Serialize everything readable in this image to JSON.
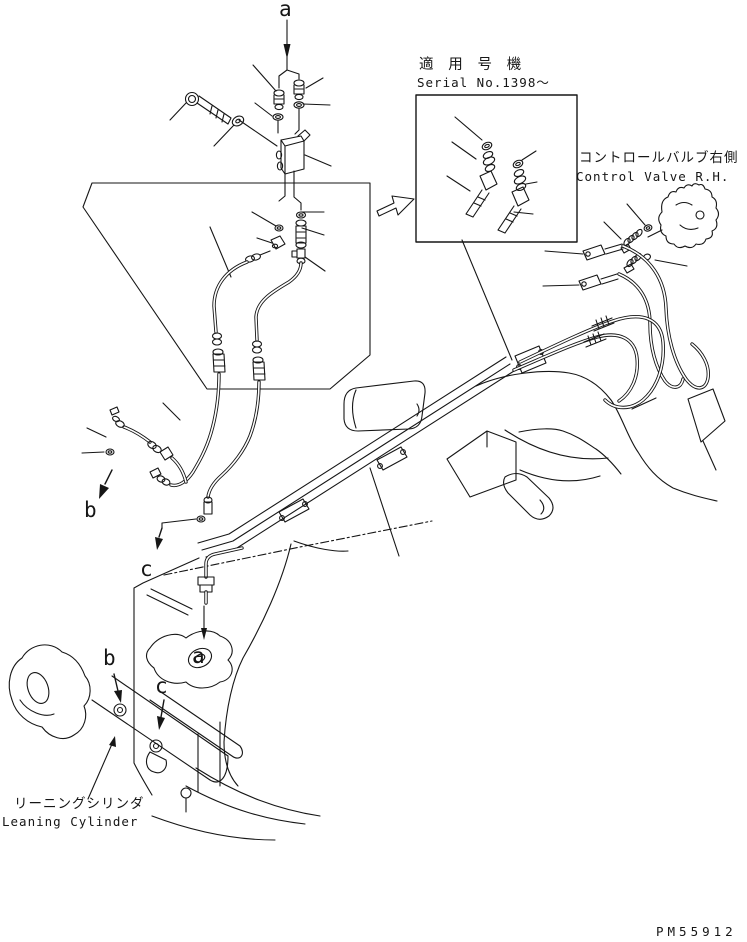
{
  "figure": {
    "background": "#ffffff",
    "line_color": "#161616"
  },
  "callouts": {
    "top_a": "a",
    "mid_b": "b",
    "mid_c": "c",
    "bottom_a": "a",
    "cylinder_b": "b",
    "cylinder_c": "c"
  },
  "serial_note": {
    "title_jp": "適 用 号 機",
    "serial_en": "Serial No.1398〜"
  },
  "control_valve": {
    "label_jp": "コントロールバルブ右側",
    "label_en": "Control Valve R.H."
  },
  "leaning_cylinder": {
    "label_jp": "リーニングシリンダ",
    "label_en": "Leaning Cylinder"
  },
  "drawing_number": "PM55912"
}
